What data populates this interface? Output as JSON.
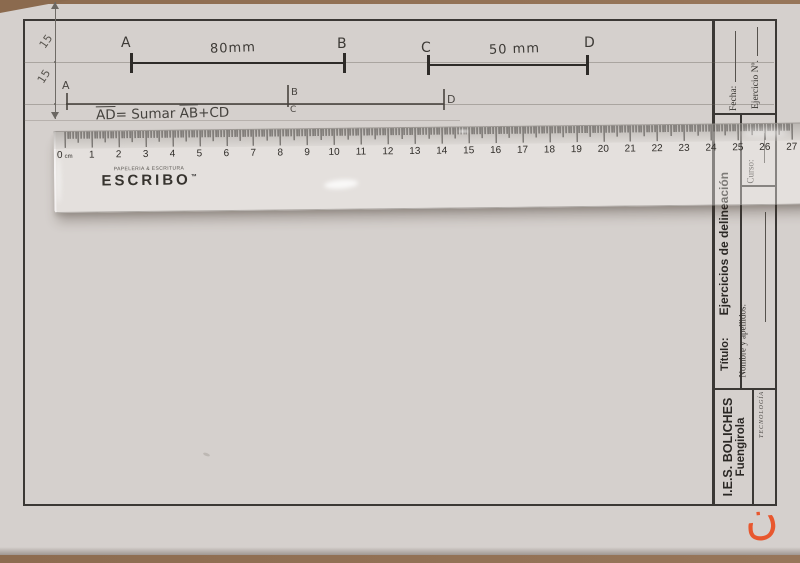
{
  "scene": {
    "table_color": "#8d6c50",
    "watermark_glyph": "ن",
    "watermark_color": "#e8572e"
  },
  "worksheet": {
    "margin_dims": {
      "top_value": "15",
      "bottom_value": "15"
    },
    "segments": [
      {
        "start": "A",
        "end": "B",
        "length": "80mm"
      },
      {
        "start": "C",
        "end": "D",
        "length": "50 mm"
      }
    ],
    "solution": {
      "start": "A",
      "join_top": "B",
      "join_bottom": "C",
      "end": "D"
    },
    "formula": {
      "lhs": "AD",
      "mid": "= Sumar",
      "ab": "AB",
      "tail": "+CD"
    }
  },
  "title_block": {
    "fecha_label": "Fecha:",
    "ejercicio_label": "Ejercicio Nº.",
    "curso_label": "Curso:",
    "titulo_label": "Título:",
    "subject_title": "Ejercicios de delineación",
    "nombre_label": "Nombre y apellidos:",
    "school_name": "I.E.S. BOLICHES",
    "school_city": "Fuengirola",
    "department": "TECNOLOGÍA"
  },
  "ruler": {
    "max_cm": 27,
    "unit": "cm",
    "brand": "ESCRIBO",
    "brand_tagline": "PAPELERIA & ESCRITURA",
    "trademark": "™"
  }
}
